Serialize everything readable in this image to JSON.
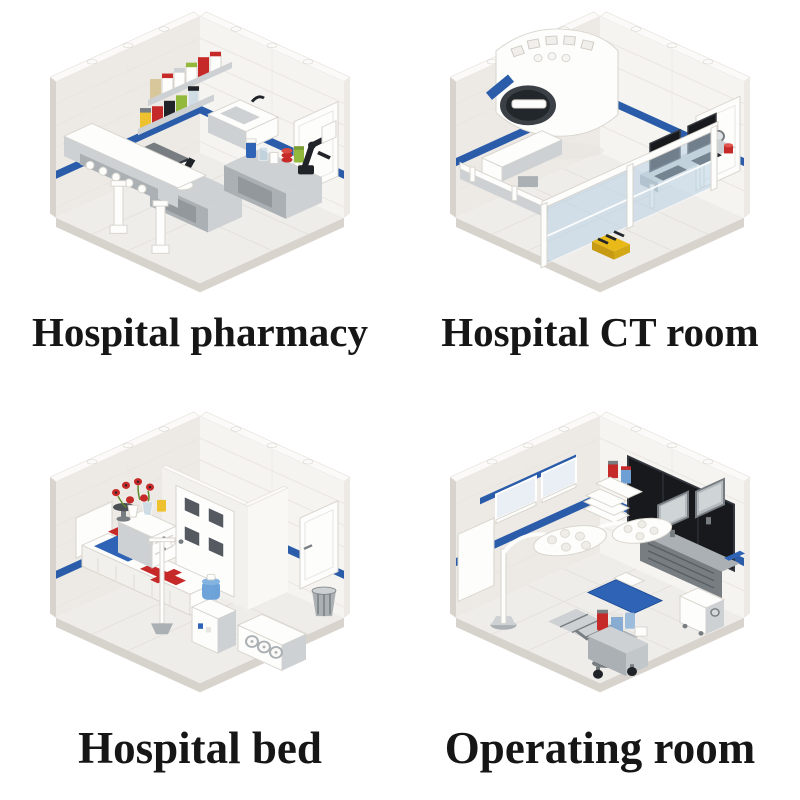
{
  "theme": {
    "background": "#ffffff",
    "caption_color": "#161616",
    "stripe_blue": "#2a5caa",
    "wall_white": "#f6f4f1",
    "wall_shade": "#edeae5",
    "wall_edge": "#d8d4cd",
    "wall_top": "#fbfaf8",
    "floor": "#efedea",
    "floor_line": "#e3e0db",
    "base_shadow": "#d6d2cc",
    "seam": "#e8e5e0",
    "gray_light": "#cdd1d3",
    "gray_mid": "#aab0b3",
    "gray_dark": "#777d81",
    "black": "#202428",
    "red": "#c62a28",
    "green": "#93b93c",
    "yellow": "#eec22f",
    "tan": "#d8c79b",
    "blue_item": "#2e63b5",
    "glass_blue": "#b9d3e6",
    "screen_dark": "#17191d",
    "hazard_yellow": "#e9b918",
    "white_item": "#fdfdfb"
  },
  "scenes": [
    {
      "id": "hospital-pharmacy",
      "caption": "Hospital pharmacy",
      "style": "isometric brick-built room, white walls with blue stripe",
      "items": [
        "medicine-shelf-canisters",
        "prep-counter-with-bottles",
        "microscope",
        "sink",
        "dispensing-machine",
        "robotic-arm",
        "side-door",
        "white-columns"
      ]
    },
    {
      "id": "hospital-ct-room",
      "caption": "Hospital CT room",
      "style": "isometric brick-built room, white walls with blue stripe",
      "items": [
        "ct-scanner",
        "patient-table",
        "glass-partition",
        "control-desk",
        "monitors",
        "emergency-button",
        "hazard-floor-block",
        "side-door"
      ]
    },
    {
      "id": "hospital-bed",
      "caption": "Hospital bed",
      "style": "isometric brick-built room, white walls with blue stripe",
      "items": [
        "bed-with-red-cross-blanket",
        "blue-blanket",
        "headboard",
        "nightstand",
        "flower-vases",
        "iv-stand",
        "water-dispenser",
        "inner-room-door-with-windows",
        "side-door",
        "trash-bin",
        "three-dial-machine"
      ]
    },
    {
      "id": "operating-room",
      "caption": "Operating room",
      "style": "isometric brick-built room, white walls with blue stripe",
      "items": [
        "wall-display",
        "surgical-lights",
        "operating-table-blue-backrest",
        "equipment-console",
        "monitors",
        "supply-cart-with-canisters",
        "anesthesia-trolley",
        "windows-with-blue-trim",
        "storage-jars",
        "tray-stack"
      ]
    }
  ]
}
